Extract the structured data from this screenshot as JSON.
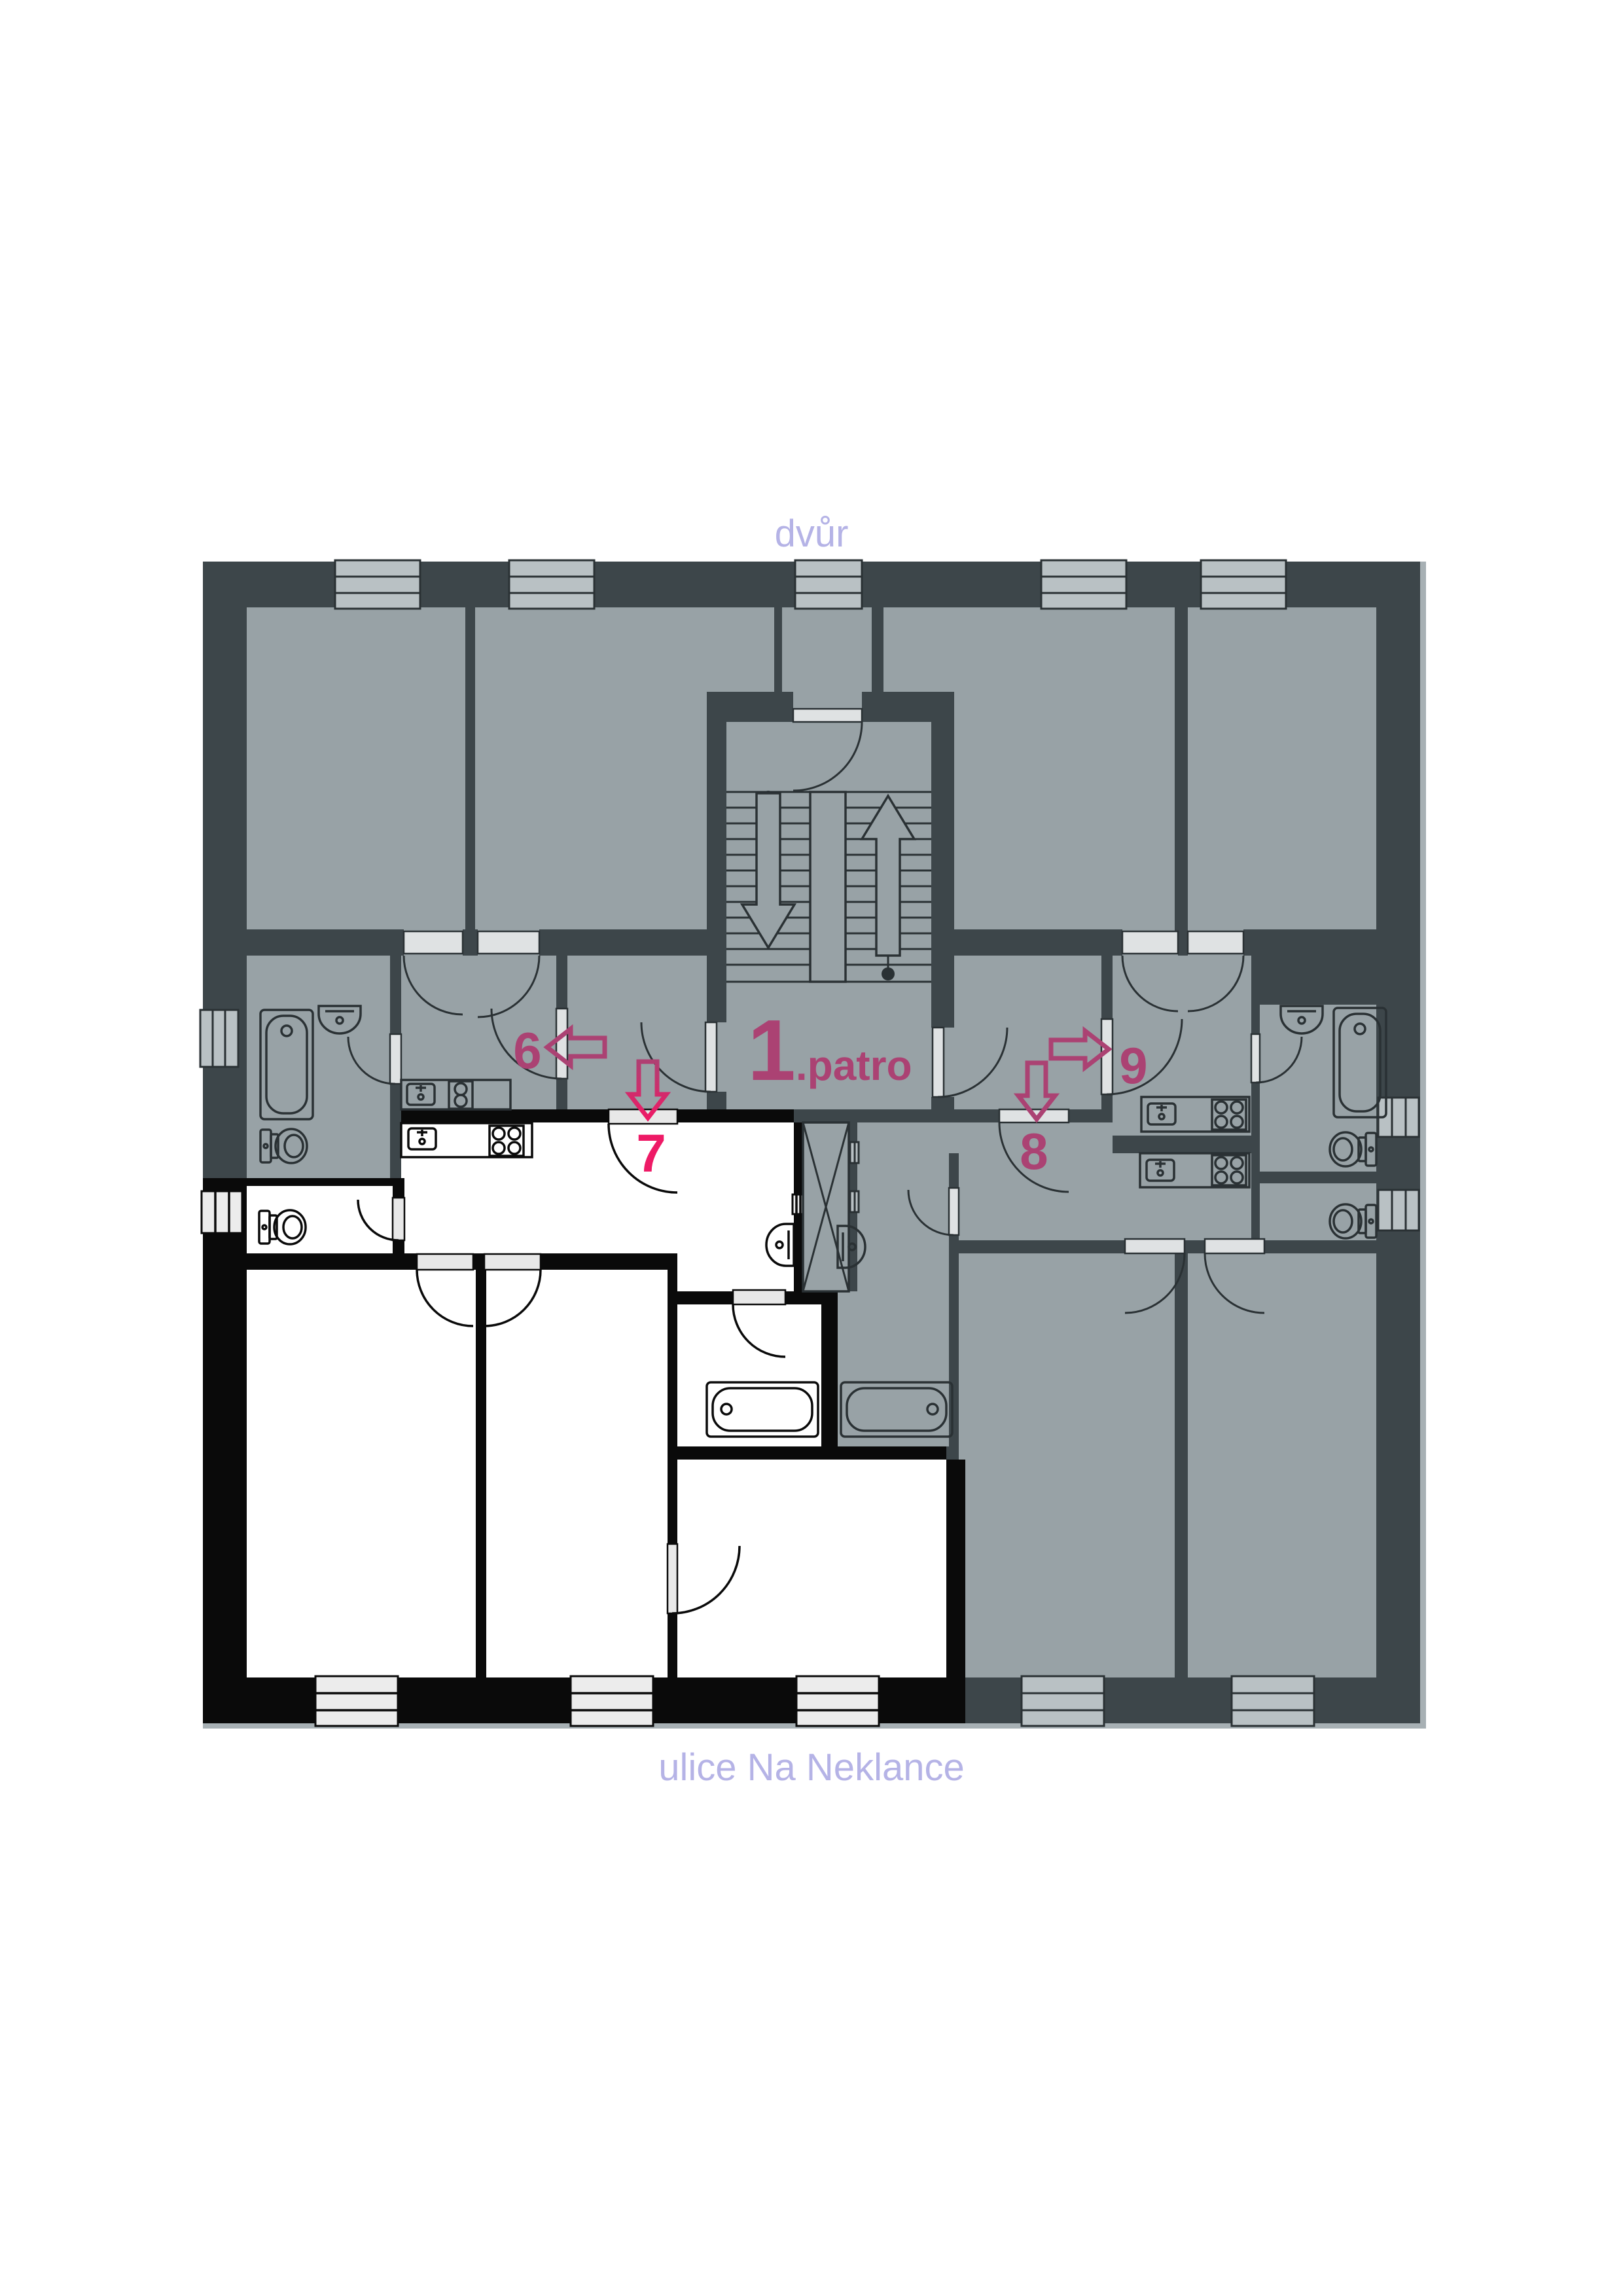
{
  "labels": {
    "courtyard": "dvůr",
    "street": "ulice Na Neklance",
    "floor_number": "1",
    "floor_suffix": ".patro"
  },
  "apartments": [
    {
      "id": "6",
      "label": "6",
      "arrow": "left",
      "highlight": false
    },
    {
      "id": "7",
      "label": "7",
      "arrow": "down",
      "highlight": true
    },
    {
      "id": "8",
      "label": "8",
      "arrow": "down",
      "highlight": false
    },
    {
      "id": "9",
      "label": "9",
      "arrow": "right",
      "highlight": false
    }
  ],
  "stairwell": {
    "up_arrow": "up",
    "down_arrow": "down"
  },
  "colors": {
    "background": "#ffffff",
    "floor": "#98a2a6",
    "floor_white": "#ffffff",
    "wall": "#3d464a",
    "wall_black": "#0a0a0a",
    "line": "#2a3134",
    "window_pane": "#b9c1c4",
    "window_pane_light": "#ececec",
    "door_leaf": "#dfe2e3",
    "door_leaf_light": "#e8e8e8",
    "facade": "#a7b0b4",
    "magenta": "#ab4273",
    "pink": "#ee1a66",
    "street_label": "#b5b3e6"
  }
}
